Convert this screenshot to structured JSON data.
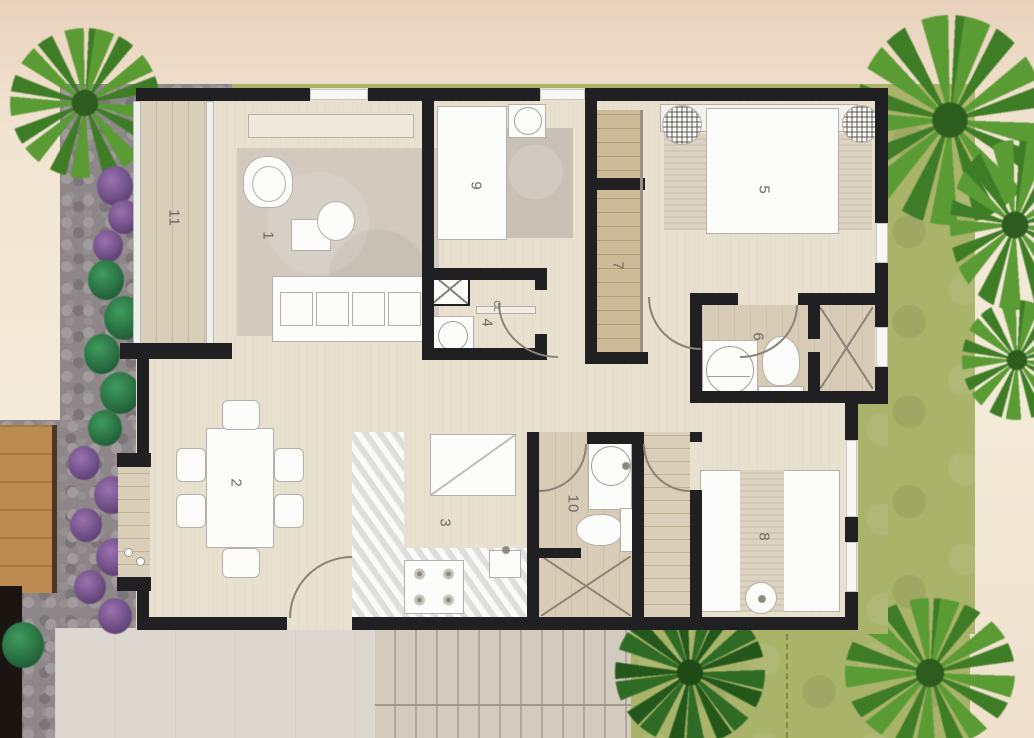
{
  "plan": {
    "room_labels": [
      {
        "number": "1"
      },
      {
        "number": "2"
      },
      {
        "number": "3"
      },
      {
        "number": "4"
      },
      {
        "number": "5"
      },
      {
        "number": "6"
      },
      {
        "number": "7"
      },
      {
        "number": "8"
      },
      {
        "number": "9"
      },
      {
        "number": "10"
      },
      {
        "number": "11"
      }
    ],
    "closet_tag": "CL"
  },
  "palette": {
    "wall": "#202023",
    "grass": "#a9b369",
    "interior_floor": "#e9e1cf",
    "terrace_wood": "#d9ceb8",
    "bath_floor": "#d9ccb6",
    "stone_path": "#8d8789",
    "background": "#f2e4d2",
    "furniture": "#fcfcfb",
    "plants_green": "#3e7d26",
    "plants_purple": "#7b5a8c"
  }
}
